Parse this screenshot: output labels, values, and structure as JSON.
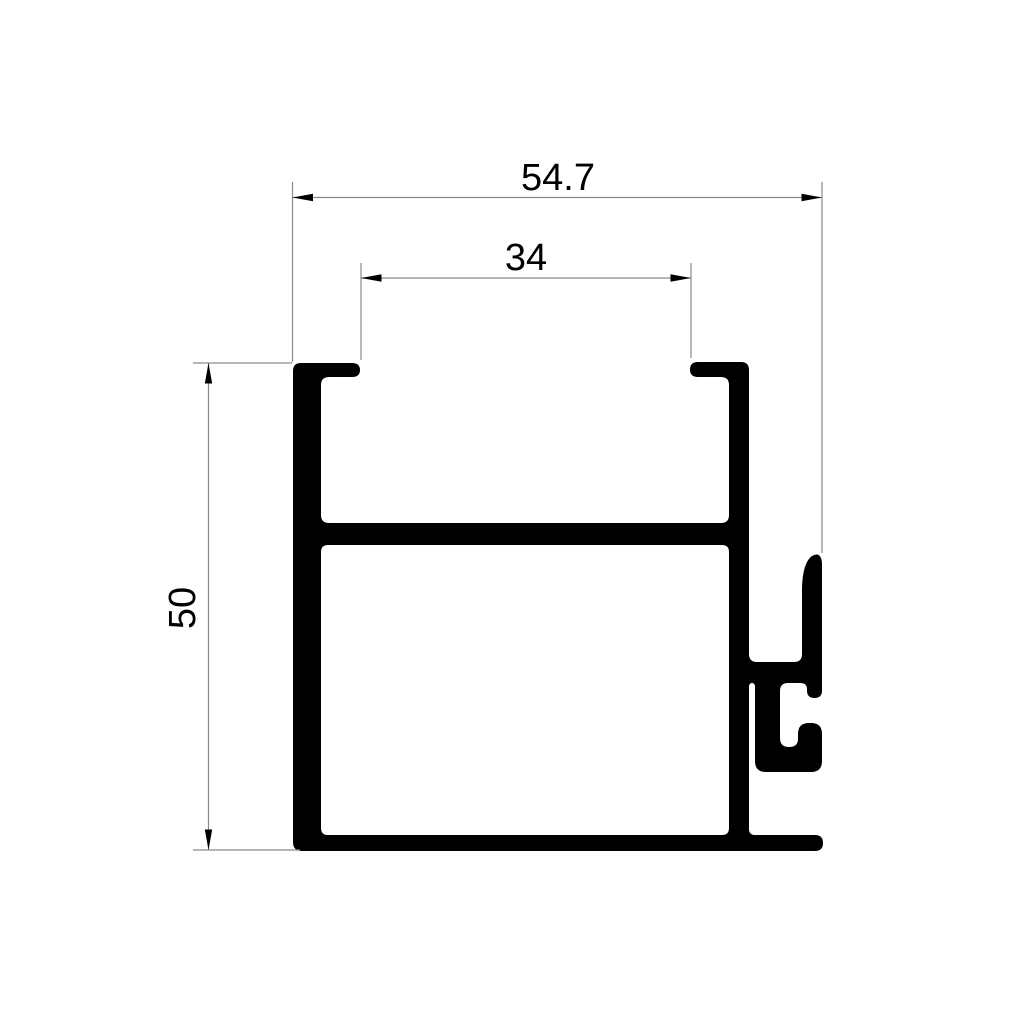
{
  "drawing": {
    "dimensions": {
      "total_width": "54.7",
      "inner_width": "34",
      "height": "50"
    },
    "style": {
      "background": "#ffffff",
      "profile_fill": "#000000",
      "dim_line_color": "#8a8a8a",
      "arrow_color": "#000000",
      "text_color": "#000000"
    }
  }
}
